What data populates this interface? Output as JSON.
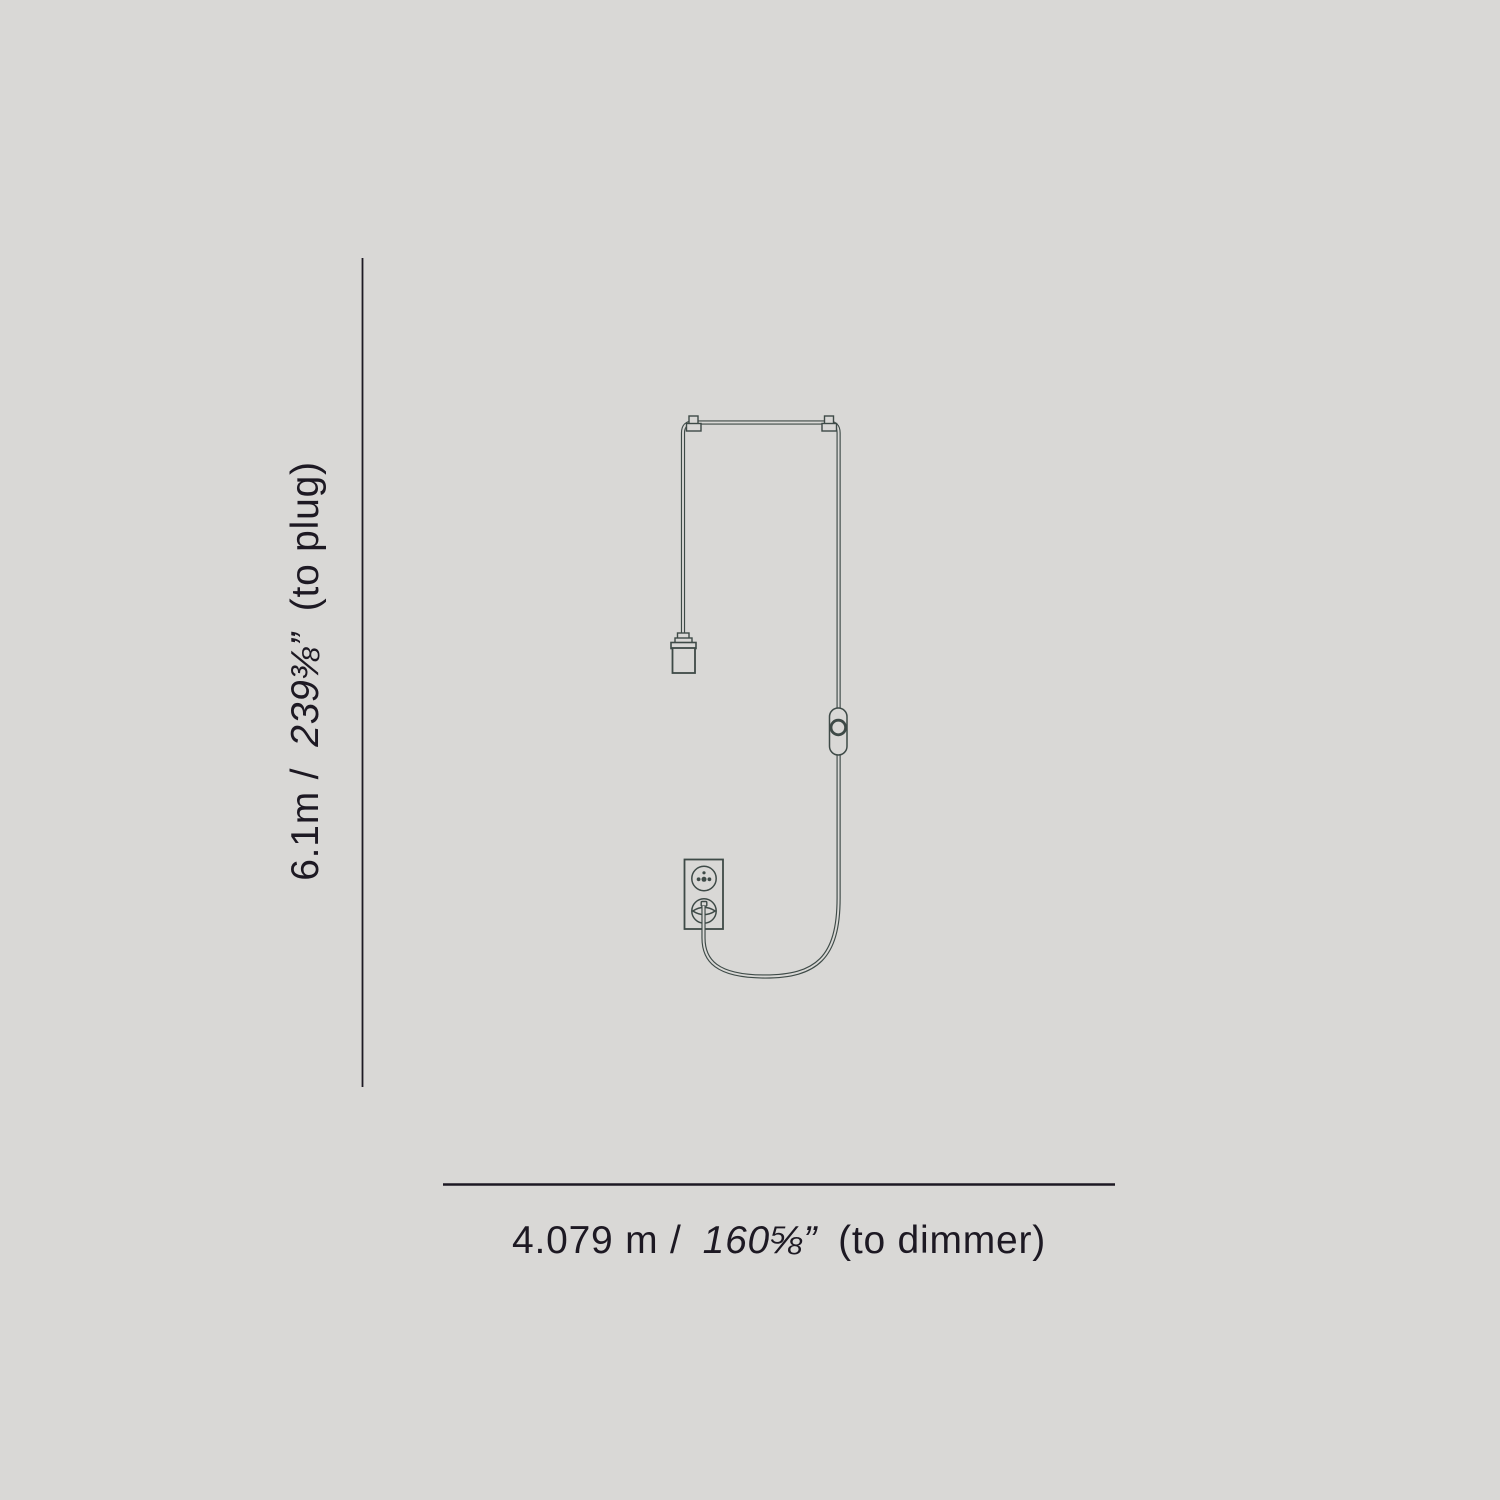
{
  "page": {
    "background": "#d9d8d6",
    "drawing_color": "#3e4a47",
    "text_color": "#1d1923"
  },
  "vertical_dimension": {
    "metric": "6.1m /",
    "imperial": "239⅜”",
    "suffix": "(to plug)"
  },
  "horizontal_dimension": {
    "metric": "4.079 m /",
    "imperial": "160⅝”",
    "suffix": "(to dimmer)"
  },
  "diagram": {
    "parts": [
      "suspension-cable",
      "mounting-clips",
      "lamp-socket",
      "inline-dimmer",
      "wall-outlet",
      "power-plug"
    ]
  }
}
